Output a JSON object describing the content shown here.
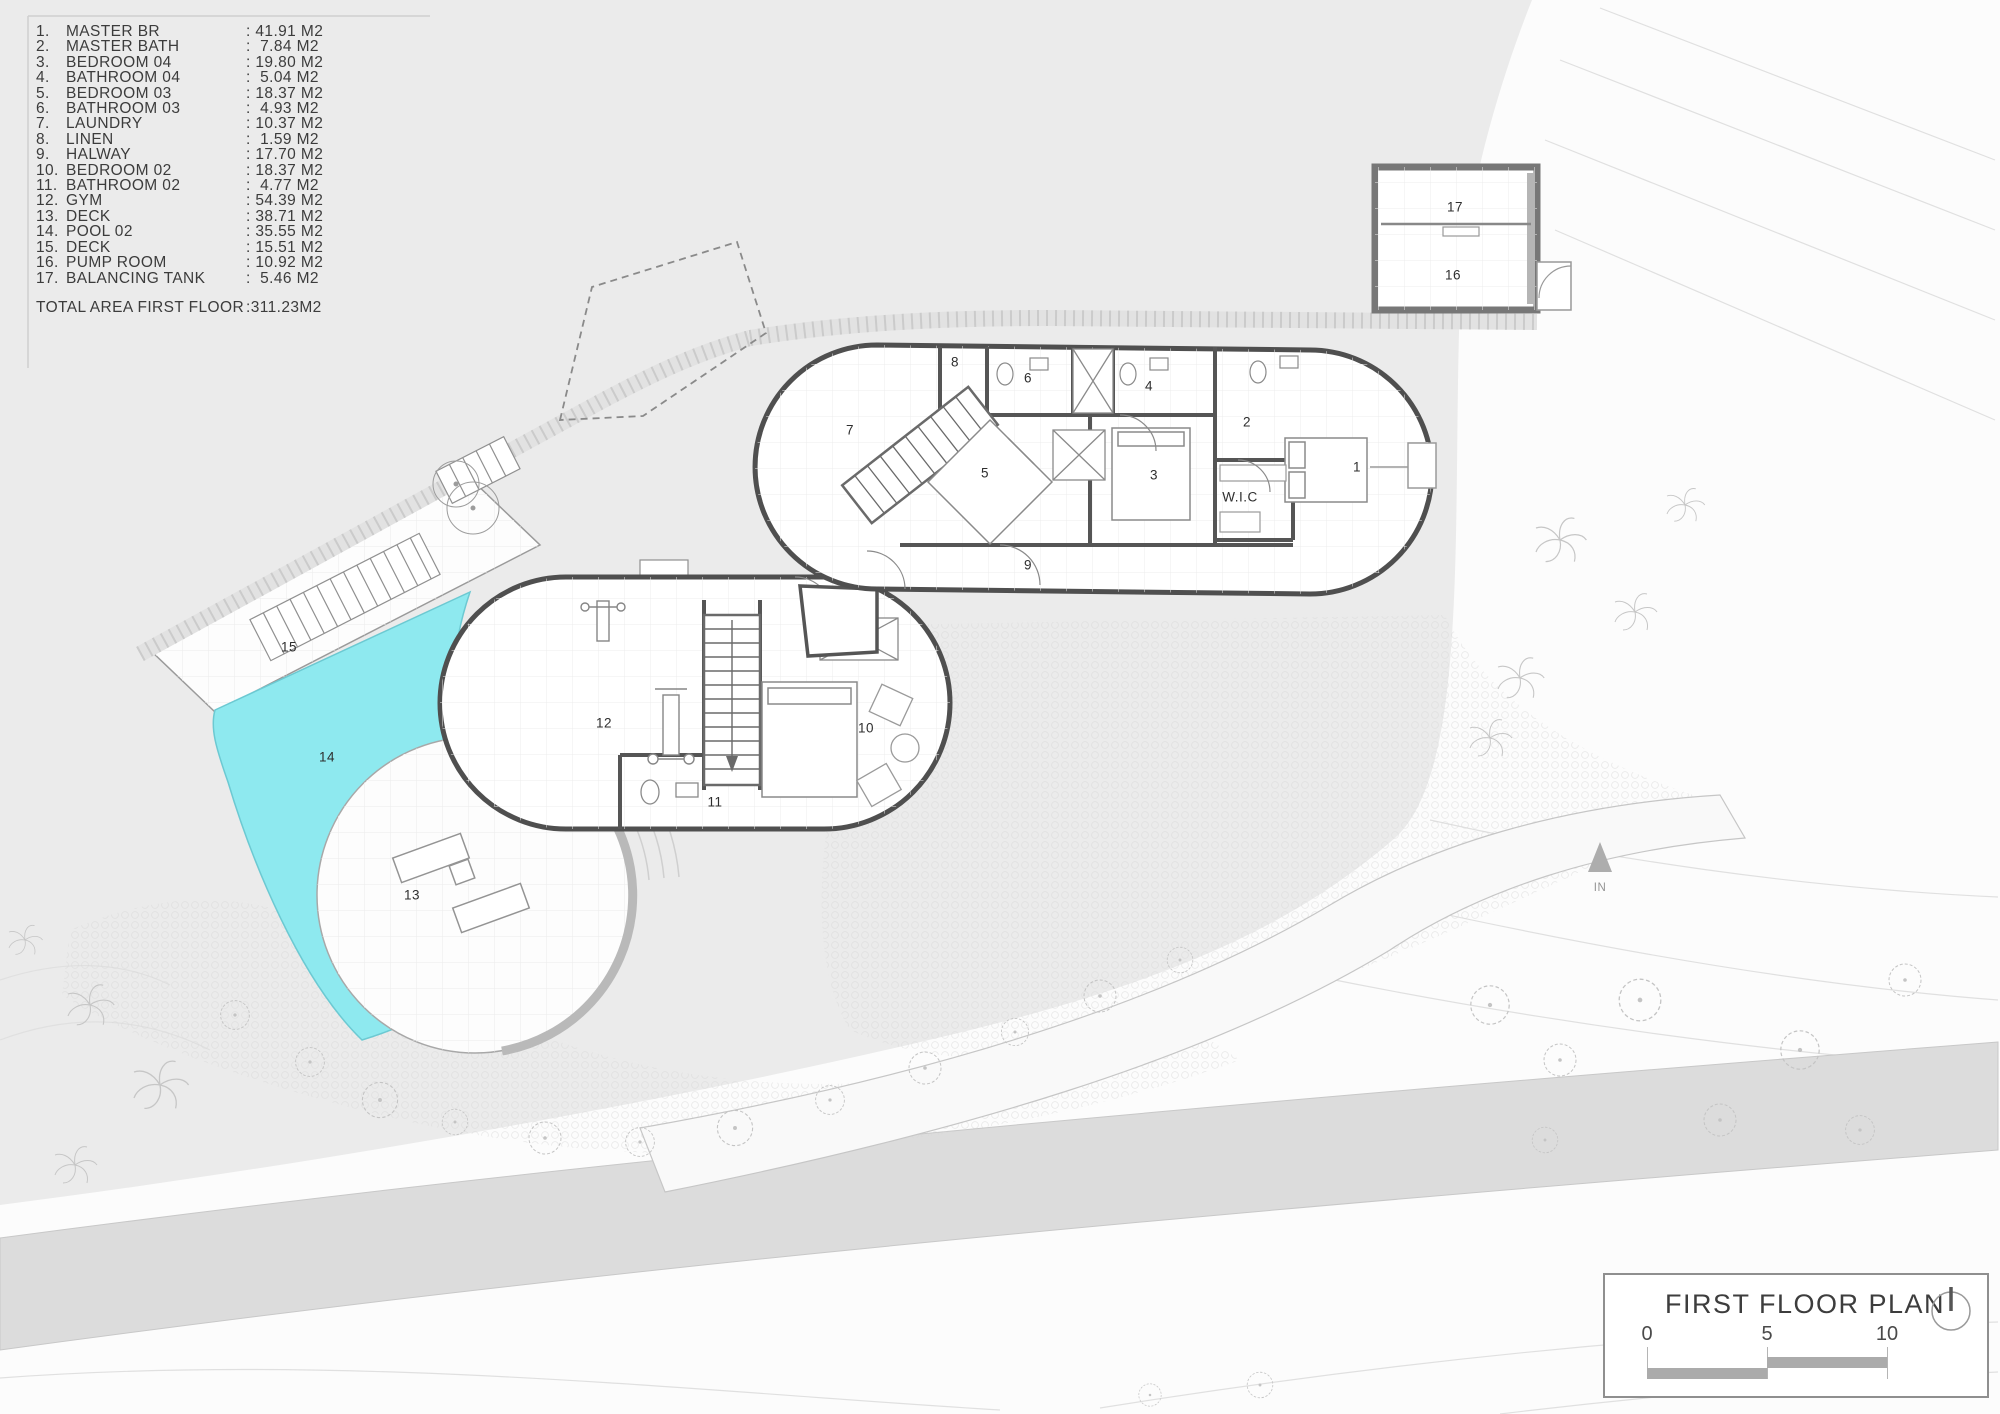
{
  "legend": {
    "items": [
      {
        "no": "1.",
        "name": "MASTER BR",
        "area": ": 41.91 M2"
      },
      {
        "no": "2.",
        "name": "MASTER BATH",
        "area": ":  7.84 M2"
      },
      {
        "no": "3.",
        "name": "BEDROOM 04",
        "area": ": 19.80 M2"
      },
      {
        "no": "4.",
        "name": "BATHROOM 04",
        "area": ":  5.04 M2"
      },
      {
        "no": "5.",
        "name": "BEDROOM 03",
        "area": ": 18.37 M2"
      },
      {
        "no": "6.",
        "name": "BATHROOM 03",
        "area": ":  4.93 M2"
      },
      {
        "no": "7.",
        "name": "LAUNDRY",
        "area": ": 10.37 M2"
      },
      {
        "no": "8.",
        "name": "LINEN",
        "area": ":  1.59 M2"
      },
      {
        "no": "9.",
        "name": "HALWAY",
        "area": ": 17.70 M2"
      },
      {
        "no": "10.",
        "name": "BEDROOM 02",
        "area": ": 18.37 M2"
      },
      {
        "no": "11.",
        "name": "BATHROOM 02",
        "area": ":  4.77 M2"
      },
      {
        "no": "12.",
        "name": "GYM",
        "area": ": 54.39 M2"
      },
      {
        "no": "13.",
        "name": "DECK",
        "area": ": 38.71 M2"
      },
      {
        "no": "14.",
        "name": "POOL 02",
        "area": ": 35.55 M2"
      },
      {
        "no": "15.",
        "name": "DECK",
        "area": ": 15.51 M2"
      },
      {
        "no": "16.",
        "name": "PUMP ROOM",
        "area": ": 10.92 M2"
      },
      {
        "no": "17.",
        "name": "BALANCING TANK",
        "area": ":  5.46 M2"
      }
    ],
    "total_label": "TOTAL AREA FIRST FLOOR",
    "total_value": ":311.23M2"
  },
  "plan": {
    "rooms": [
      {
        "label": "7",
        "x": 42.5,
        "y": 30.4
      },
      {
        "label": "8",
        "x": 47.75,
        "y": 25.6
      },
      {
        "label": "6",
        "x": 51.4,
        "y": 26.7
      },
      {
        "label": "5",
        "x": 49.25,
        "y": 33.45
      },
      {
        "label": "4",
        "x": 57.45,
        "y": 27.3
      },
      {
        "label": "3",
        "x": 57.7,
        "y": 33.6
      },
      {
        "label": "2",
        "x": 62.35,
        "y": 29.85
      },
      {
        "label": "W.I.C",
        "x": 62.0,
        "y": 35.15
      },
      {
        "label": "1",
        "x": 67.85,
        "y": 33.0
      },
      {
        "label": "9",
        "x": 51.4,
        "y": 39.95
      },
      {
        "label": "17",
        "x": 72.75,
        "y": 14.65
      },
      {
        "label": "16",
        "x": 72.65,
        "y": 19.45
      },
      {
        "label": "12",
        "x": 30.2,
        "y": 51.15
      },
      {
        "label": "10",
        "x": 43.3,
        "y": 51.5
      },
      {
        "label": "11",
        "x": 35.75,
        "y": 56.7
      },
      {
        "label": "15",
        "x": 14.45,
        "y": 45.75
      },
      {
        "label": "14",
        "x": 16.35,
        "y": 53.55
      },
      {
        "label": "13",
        "x": 20.6,
        "y": 63.3
      },
      {
        "label": "IN",
        "x": 80.0,
        "y": 62.8,
        "muted": true
      }
    ]
  },
  "titleblock": {
    "title": "FIRST FLOOR PLAN",
    "scale_ticks": [
      "0",
      "5",
      "10"
    ]
  },
  "colors": {
    "background": "#ebebeb",
    "pool": "#8ee9ef",
    "pool_edge": "#6cc9d2",
    "road": "#dcdcdc",
    "wall": "#4f4f4f",
    "text": "#3c3c3c"
  }
}
